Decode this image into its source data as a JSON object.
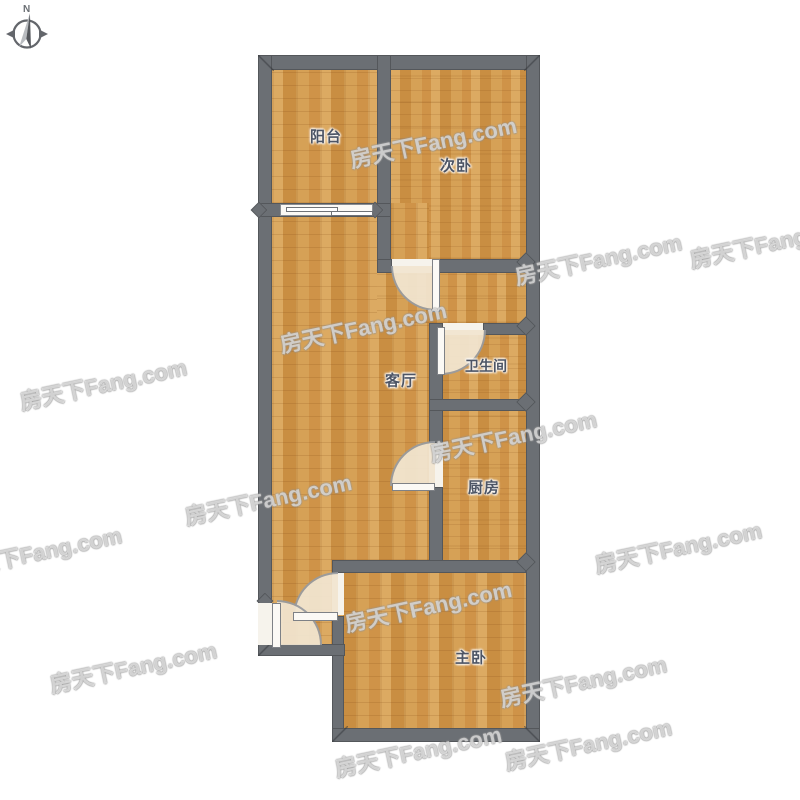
{
  "page": {
    "background": "#ffffff"
  },
  "compass": {
    "label": "N"
  },
  "watermark": {
    "text": "房天下Fang.com",
    "rotation_deg": -12,
    "positions": [
      [
        350,
        143
      ],
      [
        515,
        260
      ],
      [
        690,
        243
      ],
      [
        280,
        328
      ],
      [
        20,
        385
      ],
      [
        430,
        437
      ],
      [
        185,
        500
      ],
      [
        -45,
        553
      ],
      [
        595,
        548
      ],
      [
        345,
        607
      ],
      [
        50,
        668
      ],
      [
        500,
        682
      ],
      [
        505,
        745
      ],
      [
        335,
        752
      ]
    ]
  },
  "floorplan": {
    "rooms": [
      {
        "name": "balcony",
        "label": "阳台"
      },
      {
        "name": "bedroom2",
        "label": "次卧"
      },
      {
        "name": "living-room",
        "label": "客厅"
      },
      {
        "name": "bathroom",
        "label": "卫生间"
      },
      {
        "name": "kitchen",
        "label": "厨房"
      },
      {
        "name": "master-bedroom",
        "label": "主卧"
      }
    ],
    "colors": {
      "wall": "#6b6f74",
      "floor_wood": "#d49e54",
      "door_swing": "#f2e6d1",
      "fixture_white": "#fbf9f5",
      "label_text": "#4d5565"
    }
  }
}
